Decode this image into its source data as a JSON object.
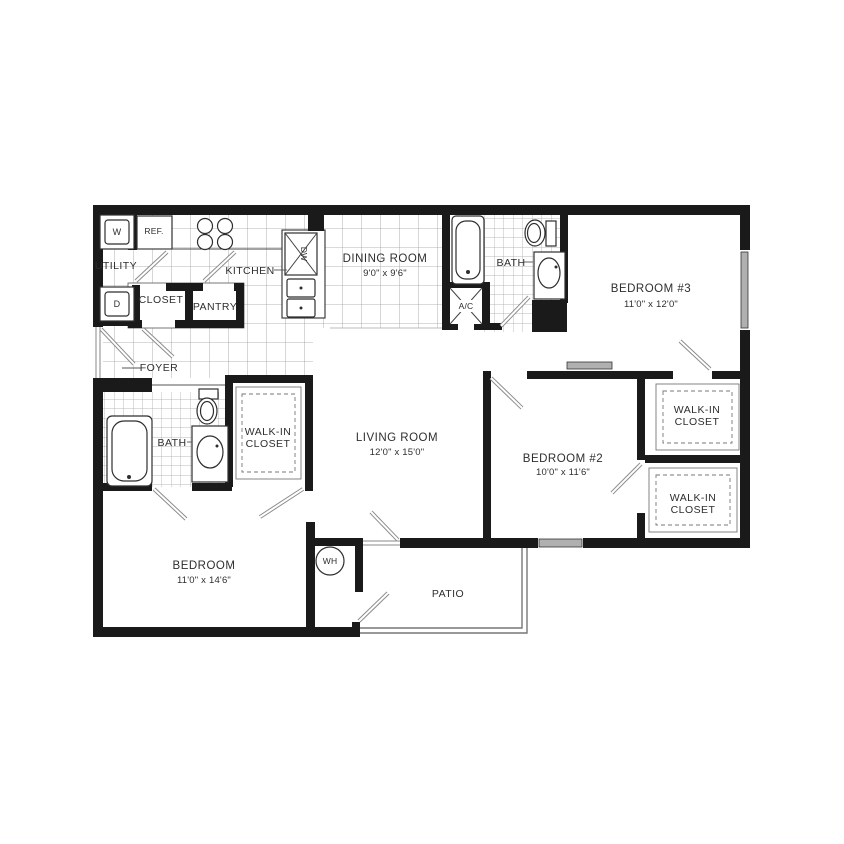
{
  "plan_title": "Three bedroom apartment floor plan",
  "rooms": {
    "utility": {
      "name": "UTILITY"
    },
    "kitchen": {
      "name": "KITCHEN"
    },
    "closet": {
      "name": "CLOSET"
    },
    "pantry": {
      "name": "PANTRY"
    },
    "foyer": {
      "name": "FOYER"
    },
    "dining_room": {
      "name": "DINING ROOM",
      "dims": "9'0\" x 9'6\""
    },
    "bath_upper": {
      "name": "BATH"
    },
    "bedroom_3": {
      "name": "BEDROOM #3",
      "dims": "11'0\" x 12'0\""
    },
    "living_room": {
      "name": "LIVING ROOM",
      "dims": "12'0\" x 15'0\""
    },
    "bedroom_2": {
      "name": "BEDROOM #2",
      "dims": "10'0\" x 11'6\""
    },
    "walkin_closet_bed3": {
      "line1": "WALK-IN",
      "line2": "CLOSET"
    },
    "walkin_closet_bed2": {
      "line1": "WALK-IN",
      "line2": "CLOSET"
    },
    "bath_lower": {
      "name": "BATH"
    },
    "walkin_closet_master": {
      "line1": "WALK-IN",
      "line2": "CLOSET"
    },
    "bedroom_master": {
      "name": "BEDROOM",
      "dims": "11'0\" x 14'6\""
    },
    "patio": {
      "name": "PATIO"
    }
  },
  "fixtures": {
    "washer": "W",
    "dryer": "D",
    "refrigerator": "REF.",
    "dishwasher": "DW",
    "ac_unit": "A/C",
    "water_heater": "WH"
  }
}
